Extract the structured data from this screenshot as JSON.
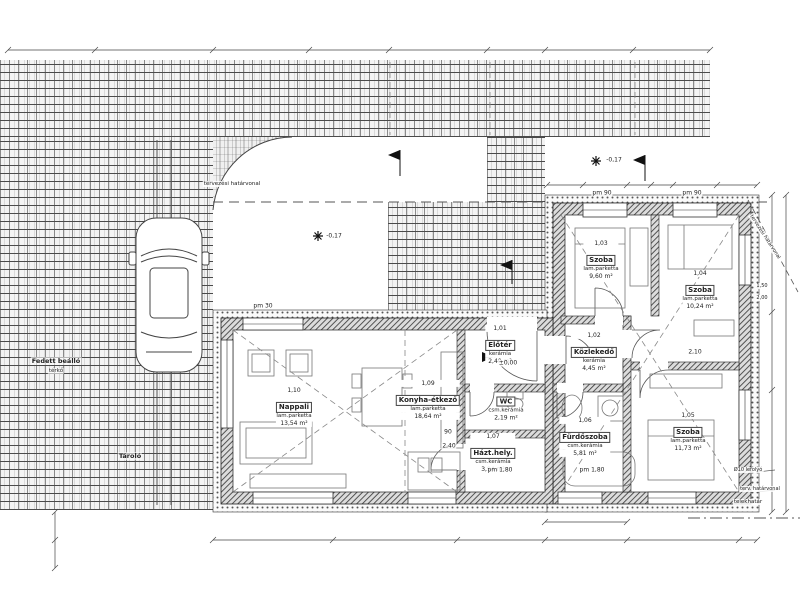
{
  "site": {
    "boundary_label_top": "tervezési határvonal",
    "boundary_label_right": "tervezési határvonal",
    "boundary_label_bottom": "terv. határvonal",
    "plot_boundary_label": "telekhatár",
    "drain_label": "Ø10 lefolyó",
    "carport_label": "Fedett beálló",
    "carport_floor": "térkő",
    "storage_label": "Tároló"
  },
  "rooms": [
    {
      "num": "1,10",
      "name": "Nappali",
      "floor": "lam.parketta",
      "area": "13,54 m²"
    },
    {
      "num": "1,09",
      "name": "Konyha-étkező",
      "floor": "lam.parketta",
      "area": "18,64 m²"
    },
    {
      "num": "1,01",
      "name": "Előtér",
      "floor": "kerámia",
      "area": "2,40 m²"
    },
    {
      "num": "1,02",
      "name": "Közlekedő",
      "floor": "kerámia",
      "area": "4,45 m²"
    },
    {
      "num": "1,03",
      "name": "Szoba",
      "floor": "lam.parketta",
      "area": "9,60 m²"
    },
    {
      "num": "1,04",
      "name": "Szoba",
      "floor": "lam.parketta",
      "area": "10,24 m²"
    },
    {
      "num": "1,05",
      "name": "Szoba",
      "floor": "lam.parketta",
      "area": "11,73 m²"
    },
    {
      "num": "1,06",
      "name": "Fürdőszoba",
      "floor": "csm.kerámia",
      "area": "5,81 m²"
    },
    {
      "num": "1,08",
      "name": "WC",
      "floor": "csm.kerámia",
      "area": "2,19 m²"
    },
    {
      "num": "1,07",
      "name": "Házt.hely.",
      "floor": "csm.kerámia",
      "area": "3,94 m²"
    }
  ],
  "markers": {
    "terrace_level": "-0,17",
    "top_level": "-0,17",
    "entry_level": "±0,00"
  },
  "dims": {
    "pm30": "pm 30",
    "pm90a": "pm 90",
    "pm90b": "pm 90",
    "pm180a": "pm 1,80",
    "pm180b": "pm 1,80",
    "d90": "90",
    "d240": "2,40",
    "d210": "2,10",
    "d150": "1,50",
    "d200": "2,00"
  },
  "colors": {
    "line": "#444",
    "hatch": "#555",
    "accent": "#000"
  }
}
